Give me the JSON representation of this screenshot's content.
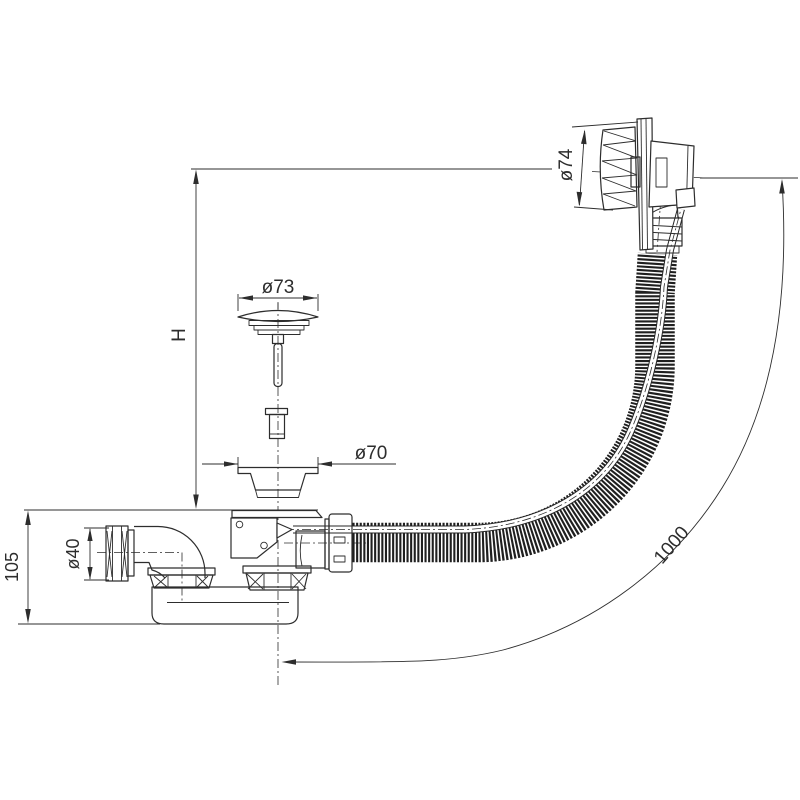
{
  "drawing": {
    "background": "#ffffff",
    "line_color": "#2d2d2d",
    "dimensions": {
      "height_ref": {
        "label": "H"
      },
      "trap_depth": {
        "label": "105"
      },
      "inlet_diameter": {
        "label": "ø40"
      },
      "plug_diameter": {
        "label": "ø73"
      },
      "flange_diameter": {
        "label": "ø70"
      },
      "overflow_diameter": {
        "label": "ø74"
      },
      "hose_length": {
        "label": "1000"
      }
    }
  }
}
